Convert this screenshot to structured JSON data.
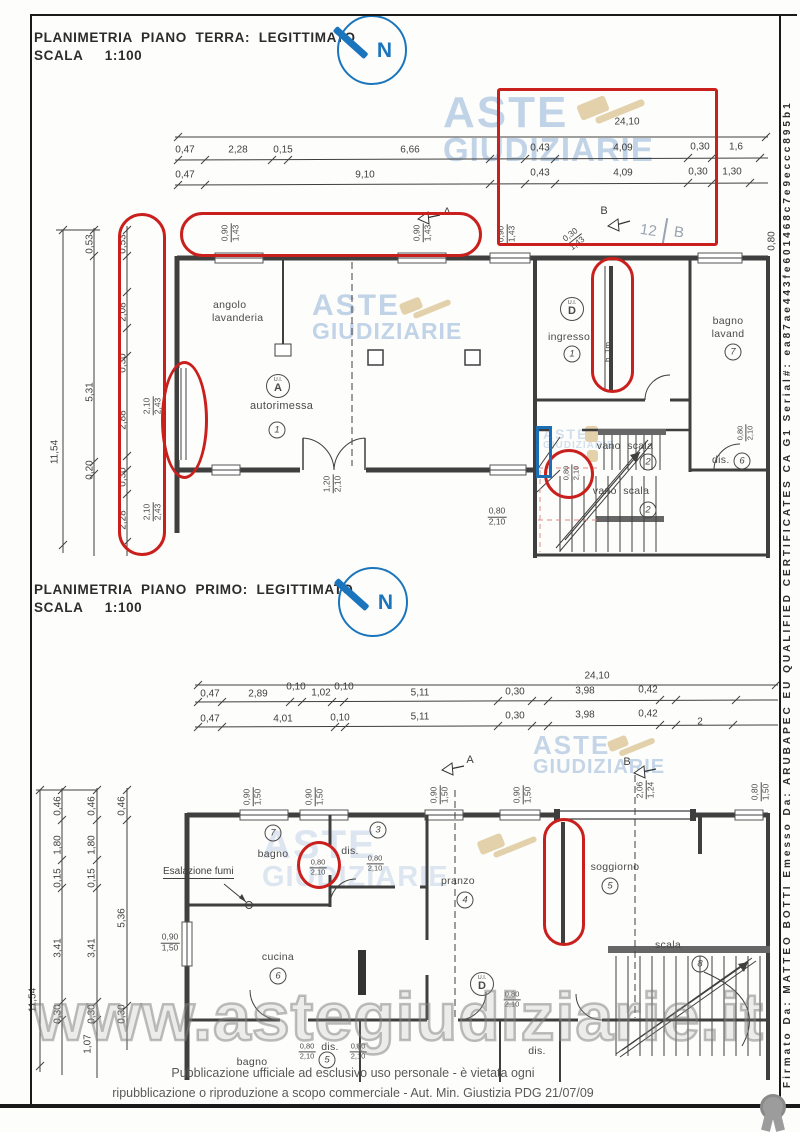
{
  "colors": {
    "annotation_red": "#c9201d",
    "annotation_blue": "#1a6fb5",
    "north_blue": "#1a75bc",
    "watermark_blue": "#b7cce4",
    "watermark_tan": "#e3d1ab",
    "line": "#3f3f3f"
  },
  "titles": {
    "pt1": "PLANIMETRIA  PIANO  TERRA:  LEGITTIMATO",
    "pt2": "SCALA     1:100",
    "pp1": "PLANIMETRIA  PIANO  PRIMO:  LEGITTIMATO",
    "pp2": "SCALA     1:100",
    "north": "N"
  },
  "footer": {
    "line1": "Pubblicazione ufficiale ad esclusivo uso personale - è vietata ogni",
    "line2": "ripubblicazione o riproduzione a scopo commerciale - Aut. Min. Giustizia PDG 21/07/09",
    "signature": "Firmato Da: MATTEO BOTTI Emesso Da: ARUBAPEC EU QUALIFIED CERTIFICATES CA G1 Serial#: ea87ae443fe601468c7e9eccc895b1"
  },
  "wm": {
    "a": "ASTE",
    "g": "GIUDIZIARIE",
    "url": "www.astegiudiziarie.it"
  },
  "pt": {
    "total": "24,10",
    "r2": [
      "0,47",
      "2,28",
      "0,15",
      "6,66",
      "0,43",
      "4,09",
      "0,30",
      "1,6"
    ],
    "r3": [
      "0,47",
      "9,10",
      "0,43",
      "4,09",
      "0,30",
      "1,30"
    ],
    "overall": "11,54",
    "lc1": [
      "0,53",
      "5,31",
      "0,20"
    ],
    "lc2": [
      "0,53",
      "2,08",
      "0,30",
      "2,88",
      "0,30",
      "2,28"
    ],
    "jamb": {
      "n": "2,10",
      "d": "2,43"
    },
    "win": {
      "n": "0,90",
      "d": "1,43"
    },
    "diag": {
      "n": "0,30",
      "d": "1,43"
    },
    "right_top": "0,80",
    "door_garage": {
      "n": "1,20",
      "d": "2,10"
    },
    "door_small": {
      "n": "0,80",
      "d": "2,10"
    },
    "door_stairs": {
      "n": "0,80",
      "d": "2,10"
    },
    "door_right": {
      "n": "0,80",
      "d": "2,10"
    },
    "h1m": "h. 1m",
    "sa": "A",
    "sb": "B",
    "hand1": "12",
    "hand2": "B",
    "ui": "U.I.",
    "uiA": "A",
    "uiD": "D",
    "rooms": {
      "angolo": "angolo",
      "lavanderia": "lavanderia",
      "autorimessa": "autorimessa",
      "ingresso": "ingresso",
      "bagno": "bagno",
      "lavand": "lavand",
      "vano": "vano  scala",
      "dis": "dis."
    },
    "nums": {
      "one": "1",
      "two": "2",
      "six": "6",
      "seven": "7"
    }
  },
  "pp": {
    "total": "24,10",
    "r2": [
      "0,47",
      "2,89",
      "0,10",
      "1,02",
      "0,10",
      "5,11",
      "0,30",
      "3,98",
      "0,42"
    ],
    "r3": [
      "0,47",
      "4,01",
      "0,10",
      "5,11",
      "0,30",
      "3,98",
      "0,42",
      "2"
    ],
    "overall": "11,54",
    "lc1": [
      "0,46",
      "1,80",
      "0,15",
      "3,41",
      "0,30"
    ],
    "lc2": [
      "0,46",
      "1,80",
      "0,15",
      "3,41",
      "0,30",
      "1,07"
    ],
    "lc3": [
      "0,46",
      "5,36",
      "0,30"
    ],
    "win": {
      "n": "0,90",
      "d": "1,50"
    },
    "win_wide": {
      "n": "2,06",
      "d": "1,24"
    },
    "win_right": {
      "n": "0,80",
      "d": "1,50"
    },
    "door": {
      "n": "0,80",
      "d": "2,10"
    },
    "esalazione": "Esalazione fumi",
    "sa": "A",
    "sb": "B",
    "ui": "U.I.",
    "uiD": "D",
    "rooms": {
      "bagno": "bagno",
      "dis": "dis.",
      "pranzo": "pranzo",
      "soggiorno": "soggiorno",
      "cucina": "cucina",
      "scala": "scala"
    },
    "nums": {
      "three": "3",
      "four": "4",
      "five": "5",
      "six": "6",
      "seven": "7",
      "eight": "8"
    }
  }
}
